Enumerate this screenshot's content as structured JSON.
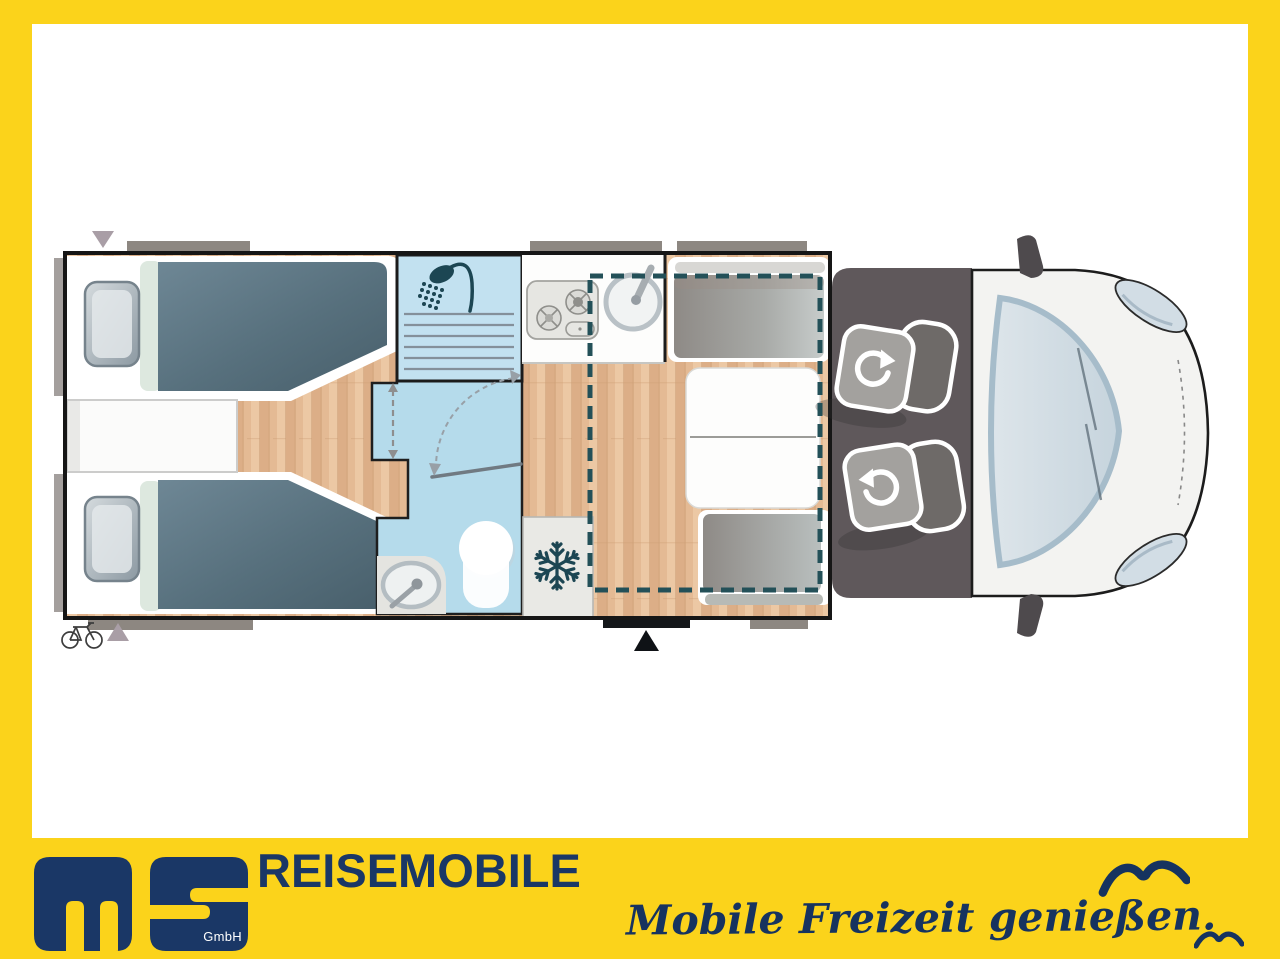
{
  "footer": {
    "logo": {
      "lettermark": "ms",
      "suffix": "GmbH"
    },
    "company": "REISEMOBILE",
    "slogan": "Mobile Freizeit genießen."
  },
  "colors": {
    "frame_yellow": "#FBD31B",
    "brand_navy": "#1A3766",
    "dash_teal": "#235058",
    "snowflake_teal": "#1C4653",
    "bath_blue": "#B5DBEB",
    "shower_blue": "#C2E1F0",
    "wood_floor": "#E4BA94",
    "blanket_slate": "#56707E",
    "cab_floor_gray": "#5F585B",
    "window_bar_gray": "#8D8781",
    "marker_mauve": "#A99EA6"
  },
  "floorplan": {
    "icons": [
      "shower-icon",
      "snowflake-icon",
      "seat-rotation-icon",
      "bicycle-icon",
      "entry-arrow-icon",
      "rear-marker-icon",
      "seagull-icon"
    ],
    "areas": [
      "twin-single-beds",
      "center-chest",
      "shower-cabin",
      "bathroom",
      "kitchen",
      "fridge",
      "dinette-with-table",
      "drop-down-bed-outline",
      "cab-swivel-seats",
      "cab-front"
    ]
  }
}
